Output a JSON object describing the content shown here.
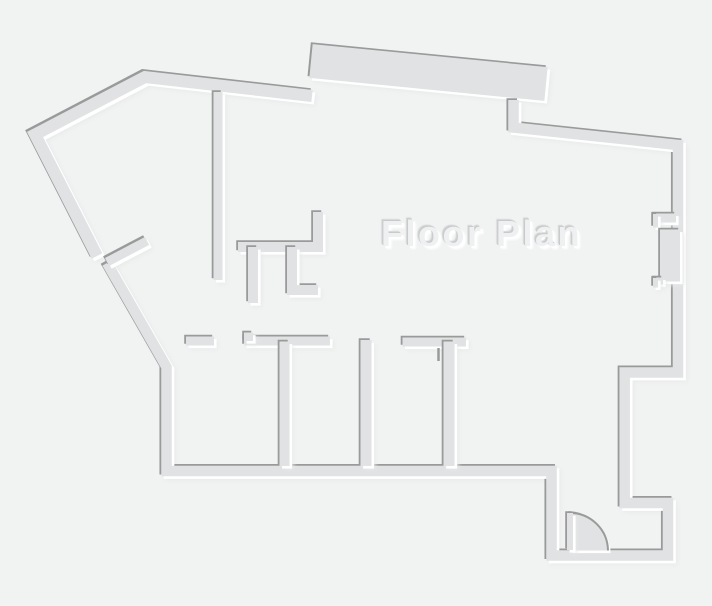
{
  "meta": {
    "width": 712,
    "height": 606,
    "description": "Embossed gray architectural floor plan drawing"
  },
  "title": {
    "text": "Floor Plan"
  },
  "palette": {
    "background": "#f1f2f2",
    "wall_fill": "#e0e2e3",
    "edge_shadow": "#9a9a9a",
    "edge_highlight": "#ffffff",
    "soft_shadow": "#e7e9e9",
    "text_fill": "#eff0f1",
    "text_edge_dark": "#c9cbcb",
    "text_edge_light": "#ffffff"
  },
  "emboss": {
    "dark_offset": -1.8,
    "light_offset": 2.6,
    "soft_offset": 4,
    "soft_blur": 2,
    "soft_opacity": 0.85
  },
  "walls": [
    {
      "name": "outer-wall-northwest",
      "d": "M 97 256 L 35 134.5 L 145 77 L 312 96",
      "w": 12
    },
    {
      "name": "parapet-top",
      "d": "M 311 61 L 546 84",
      "w": 34
    },
    {
      "name": "outer-wall-main",
      "d": "M 513.5 100 L 513.5 127.5 L 678 145 L 678 372.5 L 624.7 372.5 L 624.7 503 L 668 503 L 668 555.5 L 551.5 555.5 L 551.5 471 L 166.5 471 L 166.5 367 L 107 263",
      "w": 10.5
    },
    {
      "name": "interior-wall-hall-vertical",
      "d": "M 218 92 L 218 280",
      "w": 9
    },
    {
      "name": "interior-wall-closet-top",
      "d": "M 318 212 L 318 247 L 238 247",
      "w": 10
    },
    {
      "name": "interior-wall-closet-left",
      "d": "M 253 247 L 253 303",
      "w": 10
    },
    {
      "name": "interior-wall-closet-right",
      "d": "M 292 247 L 292 290 L 318 290",
      "w": 10
    },
    {
      "name": "diagonal-door-leaf-wall",
      "d": "M 107 262 L 147 241",
      "w": 9
    },
    {
      "name": "rooms-top-wall-a",
      "d": "M 186 341 L 214 341",
      "w": 9
    },
    {
      "name": "rooms-top-wall-b",
      "d": "M 244 341 L 330 341",
      "w": 9
    },
    {
      "name": "rooms-top-wall-b-jamb",
      "d": "M 248.5 332.5 L 248.5 341",
      "w": 9
    },
    {
      "name": "rooms-top-wall-c",
      "d": "M 402.5 342 L 466 342",
      "w": 9
    },
    {
      "name": "room-divider-1",
      "d": "M 284.5 341.5 L 284.5 466",
      "w": 10
    },
    {
      "name": "room-divider-2",
      "d": "M 366 340 L 366 466",
      "w": 11
    },
    {
      "name": "room-divider-3",
      "d": "M 449 341.5 L 449 466",
      "w": 11
    },
    {
      "name": "right-wall-jamb-upper-h",
      "d": "M 653.5 218 L 676 218",
      "w": 9
    },
    {
      "name": "right-wall-jamb-upper-v",
      "d": "M 655.5 214 L 655.5 227.5",
      "w": 5
    },
    {
      "name": "right-wall-pilaster",
      "d": "M 670 229.5 L 670 281.5",
      "w": 20
    },
    {
      "name": "right-wall-jamb-lower-h",
      "d": "M 653.5 281 L 663 281",
      "w": 7
    },
    {
      "name": "right-wall-jamb-lower-v",
      "d": "M 655.5 278 L 655.5 287.5",
      "w": 5
    }
  ],
  "door": {
    "name": "entry-door",
    "hinge_x": 570,
    "hinge_y": 550.5,
    "radius": 38,
    "swing_deg": 90,
    "pie_d": "M 570 550.5 L 570 513 A 38 38 0 0 1 608 550.5 Z",
    "arc_d": "M 570 513 A 38 38 0 0 1 608 550.5",
    "leaf_d": "M 570 513 L 570 550",
    "leaf_w": 6,
    "arc_stroke_w": 2
  },
  "marks": [
    {
      "name": "room3-door-leaf-mark",
      "d": "M 438.5 348 L 438.5 361",
      "w": 2.5
    }
  ]
}
